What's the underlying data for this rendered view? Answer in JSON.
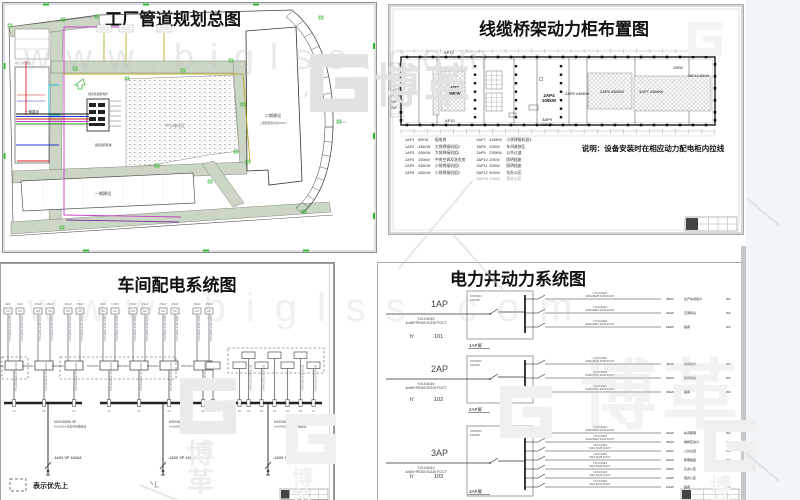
{
  "watermark": {
    "url_text": "www.biglss.com",
    "brand": "博革"
  },
  "tl": {
    "title": "工厂管道规划总图",
    "labels": {
      "phase1_left": "一期建设",
      "phase1_bottom": "一期建设",
      "phase2": "二期建设",
      "phase2_sub": "二期配套用房约750m²",
      "green_area": "中心绿化区",
      "cluster_top": "综合管廊配电间",
      "cluster_bottom": "货运装卸区域",
      "basement": "地下室范围线",
      "dim_r": "TX5.0",
      "dim_r2": "XL-1D"
    }
  },
  "tr": {
    "title": "线缆桥架动力柜布置图",
    "note": "说明：设备安装时在相应动力配电柜内拉线",
    "plan": {
      "ap11": "AP11",
      "ap10": "AP10",
      "ap2_code": "1AP2",
      "ap2_kw": "436KW",
      "ap4_code": "2AP4",
      "ap4_kw": "100kW",
      "ap5": "2AP5 436KW",
      "ap6": "2AP6 436KW",
      "ap7": "3AP7 436KW",
      "ap9_code": "3AP9",
      "ap9_kw": "235KW",
      "kw20": "20KW",
      "ap13": "3AP13 40KW",
      "left_stack": [
        "1AP1",
        "50KW",
        "1AP",
        "2AP"
      ]
    },
    "legend_left": [
      [
        "1AP1",
        "50KW",
        "配电房"
      ],
      [
        "1AP2",
        "436KW",
        "大袋焊接机组2"
      ],
      [
        "1AP3",
        "436KW",
        "大袋焊接机组1"
      ],
      [
        "2AP4",
        "100kW",
        "中央空调及洗衣房"
      ],
      [
        "2AP5",
        "436KW",
        "小袋焊接机组1"
      ],
      [
        "2AP6",
        "436KW",
        "小袋焊接机组2"
      ]
    ],
    "legend_right": [
      [
        "3AP7",
        "436KW",
        "小袋焊接机组3"
      ],
      [
        "3AP8",
        "20KW",
        "车间维修区"
      ],
      [
        "3AP9",
        "235KW",
        "公共过道"
      ],
      [
        "3AP10",
        "20KW",
        "照明插座"
      ],
      [
        "3AP11",
        "20KW",
        "照明插座"
      ],
      [
        "3AP12",
        "50KW",
        "东办公区"
      ],
      [
        "3AP13",
        "40KW",
        "西办公区"
      ]
    ]
  },
  "bl": {
    "title": "车间配电系统图",
    "legend_note": "表示优先上",
    "feeder_kw": [
      "6kW",
      "6kW",
      "25kW",
      "25kW",
      "25kW",
      "25kW",
      "8kW",
      "4.5kW",
      "25kW",
      "25kW",
      "25kW",
      "25kW",
      "25kW",
      "25kW"
    ],
    "mid_label": "NSX250N",
    "cable_top": "YJV-4x25+1x16 SC40",
    "cable_mid": "YJV-4x120+1x70 SC100",
    "riser_line1": "NSX1600N 3P",
    "riser_line2": "In=1600A 密集母线槽连接",
    "mains": [
      "-1600 3P 1600A",
      "-1600 3P 160A",
      "-1600 3P 1250A"
    ],
    "w_prefix": "W"
  },
  "br": {
    "title": "电力井动力系统图",
    "blocks": [
      {
        "name": "1AP",
        "cable1": "YJV-0.6/1kV",
        "cable2": "4x400+PE400 SC100 FC/CT",
        "hn": "h'",
        "num": "101",
        "panel": "1AP屏",
        "inner1": "NSX630N",
        "inner2": "630A/3P",
        "branches": [
          {
            "c1": "YJV-0.6/1kV",
            "c2": "4x50+PE25 SC50 FC/CT",
            "kw": "45kW",
            "area": "生产车间动力",
            "w": "W1"
          },
          {
            "c1": "YJV-0.6/1kV",
            "c2": "4x35+PE16 SC40 FC/CT",
            "kw": "30kW",
            "area": "空调机房",
            "w": "W2"
          },
          {
            "c1": "YJV-0.6/1kV",
            "c2": "4x25+PE16 SC32 FC/CT",
            "kw": "18kW",
            "area": "备用",
            "w": "W3"
          }
        ]
      },
      {
        "name": "2AP",
        "cable1": "YJV-0.6/1kV",
        "cable2": "4x400+PE400 SC100 FC/CT",
        "hn": "h'",
        "num": "102",
        "panel": "2AP屏",
        "inner1": "NSX630N",
        "inner2": "630A/3P",
        "branches": [
          {
            "c1": "YJV-0.6/1kV",
            "c2": "4x50+PE25 SC50 FC/CT",
            "kw": "45kW",
            "area": "车间动力",
            "w": "W1"
          },
          {
            "c1": "YJV-0.6/1kV",
            "c2": "4x35+PE16 SC40 FC/CT",
            "kw": "30kW",
            "area": "新风机房",
            "w": "W2"
          },
          {
            "c1": "YJV-0.6/1kV",
            "c2": "4x25+PE16 SC32 FC/CT",
            "kw": "15kW",
            "area": "备用",
            "w": "W3"
          }
        ]
      },
      {
        "name": "3AP",
        "cable1": "YJV-0.6/1kV",
        "cable2": "4x600+PE300 SC150 FC/CT",
        "hn": "h'",
        "num": "103",
        "panel": "3AP屏",
        "inner1": "NSX630N",
        "inner2": "630A/3P",
        "branches": [
          {
            "c1": "YJV-0.6/1kV",
            "c2": "4x35+PE16 SC40 FC/CT",
            "kw": "30kW",
            "area": "车间照明",
            "w": "W1"
          },
          {
            "c1": "YJV-0.6/1kV",
            "c2": "4x25+PE16 SC32 FC/CT",
            "kw": "25kW",
            "area": "维修区动力",
            "w": "W2"
          },
          {
            "c1": "YJV-0.6/1kV",
            "c2": "5x16 SC25 FC/CT",
            "kw": "20kW",
            "area": "公共过道",
            "w": "W3"
          },
          {
            "c1": "YJV-0.6/1kV",
            "c2": "5x16 SC25 FC/CT",
            "kw": "20kW",
            "area": "照明插座",
            "w": "W4"
          },
          {
            "c1": "YJV-0.6/1kV",
            "c2": "5x10 SC20 FC/CT",
            "kw": "15kW",
            "area": "东办公区",
            "w": "W5"
          },
          {
            "c1": "YJV-0.6/1kV",
            "c2": "5x10 SC20 FC/CT",
            "kw": "12kW",
            "area": "西办公区",
            "w": "W6"
          },
          {
            "c1": "YJV-0.6/1kV",
            "c2": "5x10 SC20 FC/CT",
            "kw": "10kW",
            "area": "备用",
            "w": "W7"
          }
        ]
      }
    ]
  }
}
